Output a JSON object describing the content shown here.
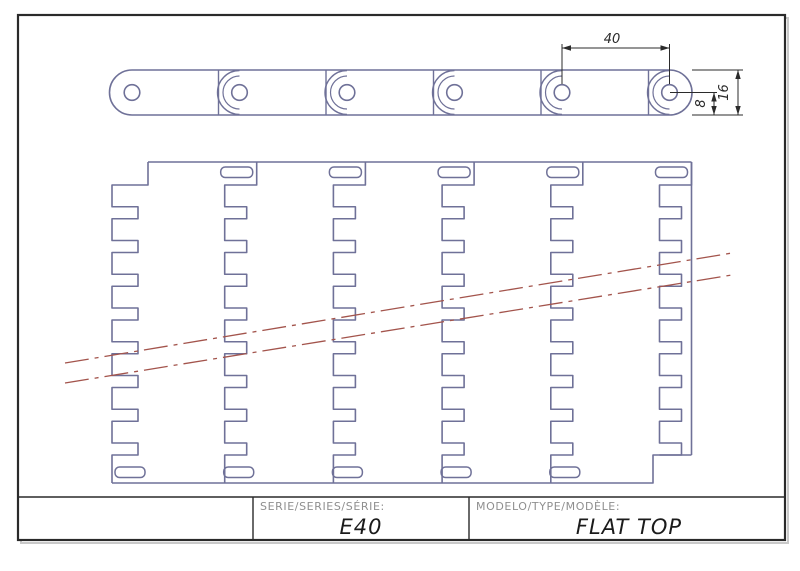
{
  "drawing": {
    "title_block": {
      "serie_label": "SERIE/SERIES/SÉRIE:",
      "serie_value": "E40",
      "modelo_label": "MODELO/TYPE/MODÈLE:",
      "modelo_value": "FLAT TOP"
    },
    "dimensions": {
      "pitch": "40",
      "link_height": "16",
      "pin_to_bottom": "8"
    },
    "colors": {
      "outline": "#6f7198",
      "centerline": "#a3544c",
      "dimension": "#2b2b2b",
      "frame": "#2a2a2a",
      "label_gray": "#8f8f8f",
      "value_dark": "#1b1b1b"
    },
    "side_view": {
      "pin_xs": [
        132,
        239.5,
        347,
        454.5,
        562,
        669.5
      ],
      "top": 70,
      "bottom": 115,
      "cap_radius": 22.5,
      "pin_radius": 7.8,
      "junction_offset": 21,
      "inner_arc_radius": 16.5,
      "dim40": {
        "x1": 562,
        "x2": 669.5,
        "y": 48,
        "ext_top": 44,
        "ext_bottom": 84,
        "label_x": 612,
        "label_y": 43
      },
      "dim16": {
        "x": 738,
        "y1": 70,
        "y2": 115,
        "ext_x1": 692,
        "ext_x2": 743,
        "label_x": 728,
        "label_y": 92.5
      },
      "dim8": {
        "x": 714,
        "y1": 92.5,
        "y2": 115,
        "leader_x1": 670,
        "leader_x2": 717,
        "label_x": 705,
        "label_y": 103.5
      }
    },
    "plan_view": {
      "joint_xs": [
        148,
        256.7,
        365.4,
        474.1,
        582.8,
        691.5
      ],
      "top": 162,
      "teeth_top": 185,
      "teeth_bottom": 455,
      "bottom": 483,
      "left": 112,
      "bottom_notch_x": 653,
      "tooth_cycles": 8,
      "tooth_out": 21.75,
      "tooth_in": 12,
      "tip_offset": 32,
      "first_tip_offset": 36,
      "notch_offset": 10,
      "top_slots": {
        "joints": [
          1,
          2,
          3,
          4,
          5
        ],
        "dx": -36,
        "y": 167,
        "w": 32,
        "h": 10.5,
        "r": 4.5
      },
      "bottom_slots": {
        "joints": [
          0,
          1,
          2,
          3,
          4
        ],
        "dx": -33,
        "y": 467,
        "w": 30,
        "h": 10.5,
        "r": 4.5
      },
      "centerlines": [
        [
          65,
          363,
          732,
          253
        ],
        [
          65,
          383,
          732,
          275
        ]
      ]
    },
    "frame": {
      "x": 18,
      "y": 15,
      "w": 767,
      "h": 525
    },
    "title_block_geom": {
      "top": 497,
      "div1": 253,
      "div2": 469,
      "serie_label_x": 260,
      "modelo_label_x": 476,
      "label_y": 510,
      "serie_value_x": 361,
      "modelo_value_x": 629,
      "value_y": 534
    }
  }
}
